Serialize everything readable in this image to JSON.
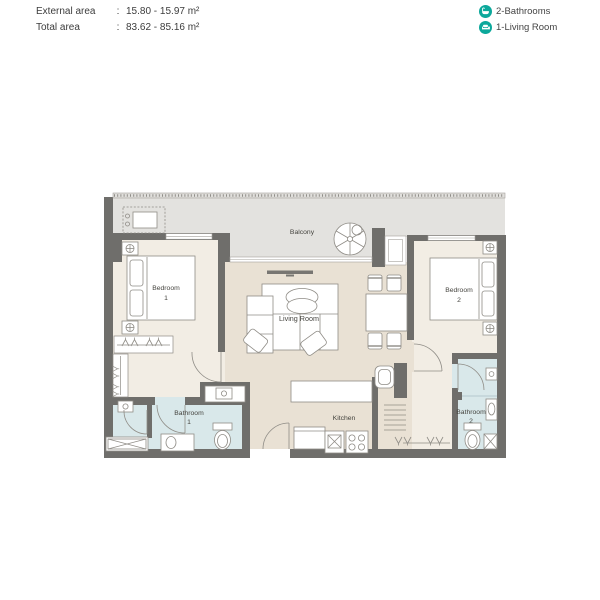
{
  "header": {
    "rows": [
      {
        "label": "External area",
        "colon": ":",
        "value": "15.80 - 15.97 m²"
      },
      {
        "label": "Total area",
        "colon": ":",
        "value": "83.62 - 85.16 m²"
      }
    ]
  },
  "legend": {
    "items": [
      {
        "icon": "bathtub-icon",
        "label": "2-Bathrooms"
      },
      {
        "icon": "sofa-icon",
        "label": "1-Living Room"
      }
    ]
  },
  "plan": {
    "labels": {
      "balcony": "Balcony",
      "living_room": "Living Room",
      "kitchen": "Kitchen",
      "bedroom1_l1": "Bedroom",
      "bedroom1_l2": "1",
      "bedroom2_l1": "Bedroom",
      "bedroom2_l2": "2",
      "bathroom1_l1": "Bathroom",
      "bathroom1_l2": "1",
      "bathroom2_l1": "Bathroom",
      "bathroom2_l2": "2"
    }
  },
  "colors": {
    "accent_teal": "#0ca89b",
    "wall": "#6f6e6b",
    "room_light": "#f2ede4",
    "room_dark": "#e9e1d4",
    "balcony": "#e3e2df",
    "bathroom": "#d9e8ea",
    "furniture_stroke": "#8f8c86",
    "text": "#45443f"
  }
}
